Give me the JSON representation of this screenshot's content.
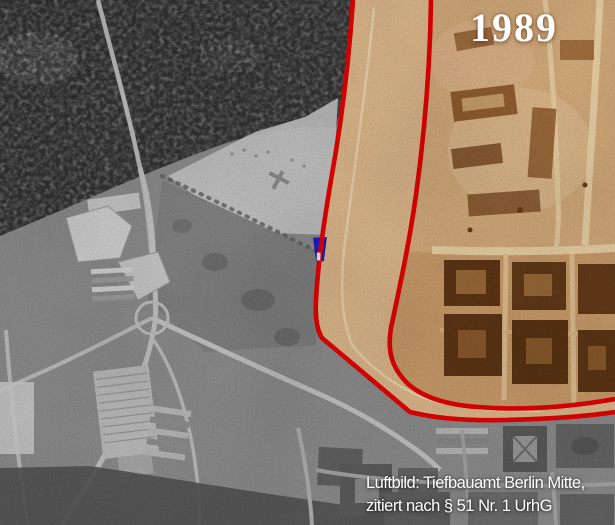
{
  "overlay": {
    "year_label": "1989",
    "attribution_line1": "Luftbild: Tiefbauamt Berlin Mitte,",
    "attribution_line2": "zitiert nach § 51 Nr. 1 UrhG"
  },
  "colors": {
    "border-line": "#e60000",
    "marker-blue": "#2119ce",
    "label-text": "#ffffff",
    "west-gray": "#8d8d8d",
    "east-sepia": "#cb9d6b",
    "strip-tan": "#dfb98c"
  }
}
